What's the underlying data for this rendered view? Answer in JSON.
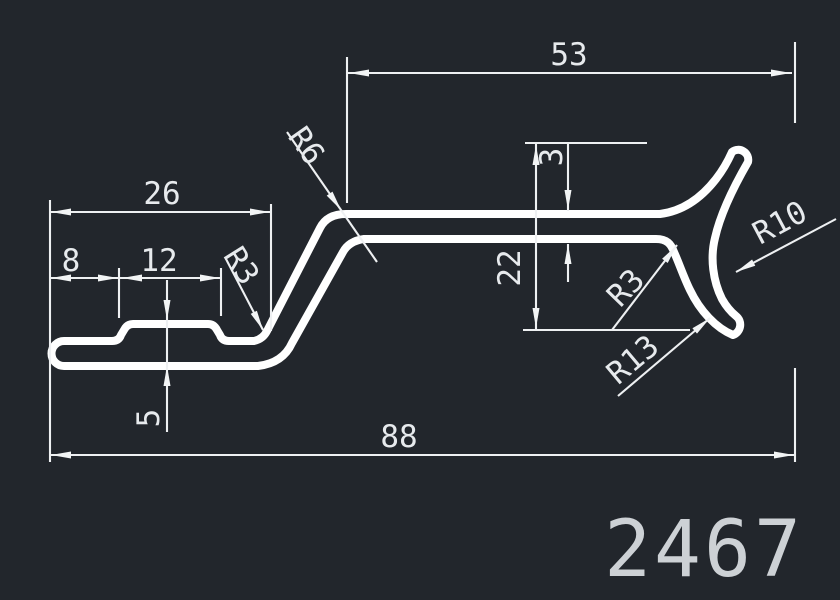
{
  "drawing_type": "aluminium-profile-cross-section",
  "part_number": "2467",
  "colors": {
    "background": "#22262c",
    "profile_line": "#ffffff",
    "dimension_line": "#eef0f2",
    "dimension_text": "#e7eaed",
    "part_number_text": "#cdd1d5"
  },
  "dimensions": {
    "upper_arm_length": "53",
    "base_left_width": "26",
    "notch_offset": "8",
    "notch_width": "12",
    "base_height": "5",
    "overall_width": "88",
    "fork_height": "22",
    "wall_thickness": "3"
  },
  "radii": {
    "upper_bend": "R6",
    "lower_bend": "R3",
    "fork_fillet": "R3",
    "fork_mouth": "R10",
    "fork_outer": "R13"
  }
}
